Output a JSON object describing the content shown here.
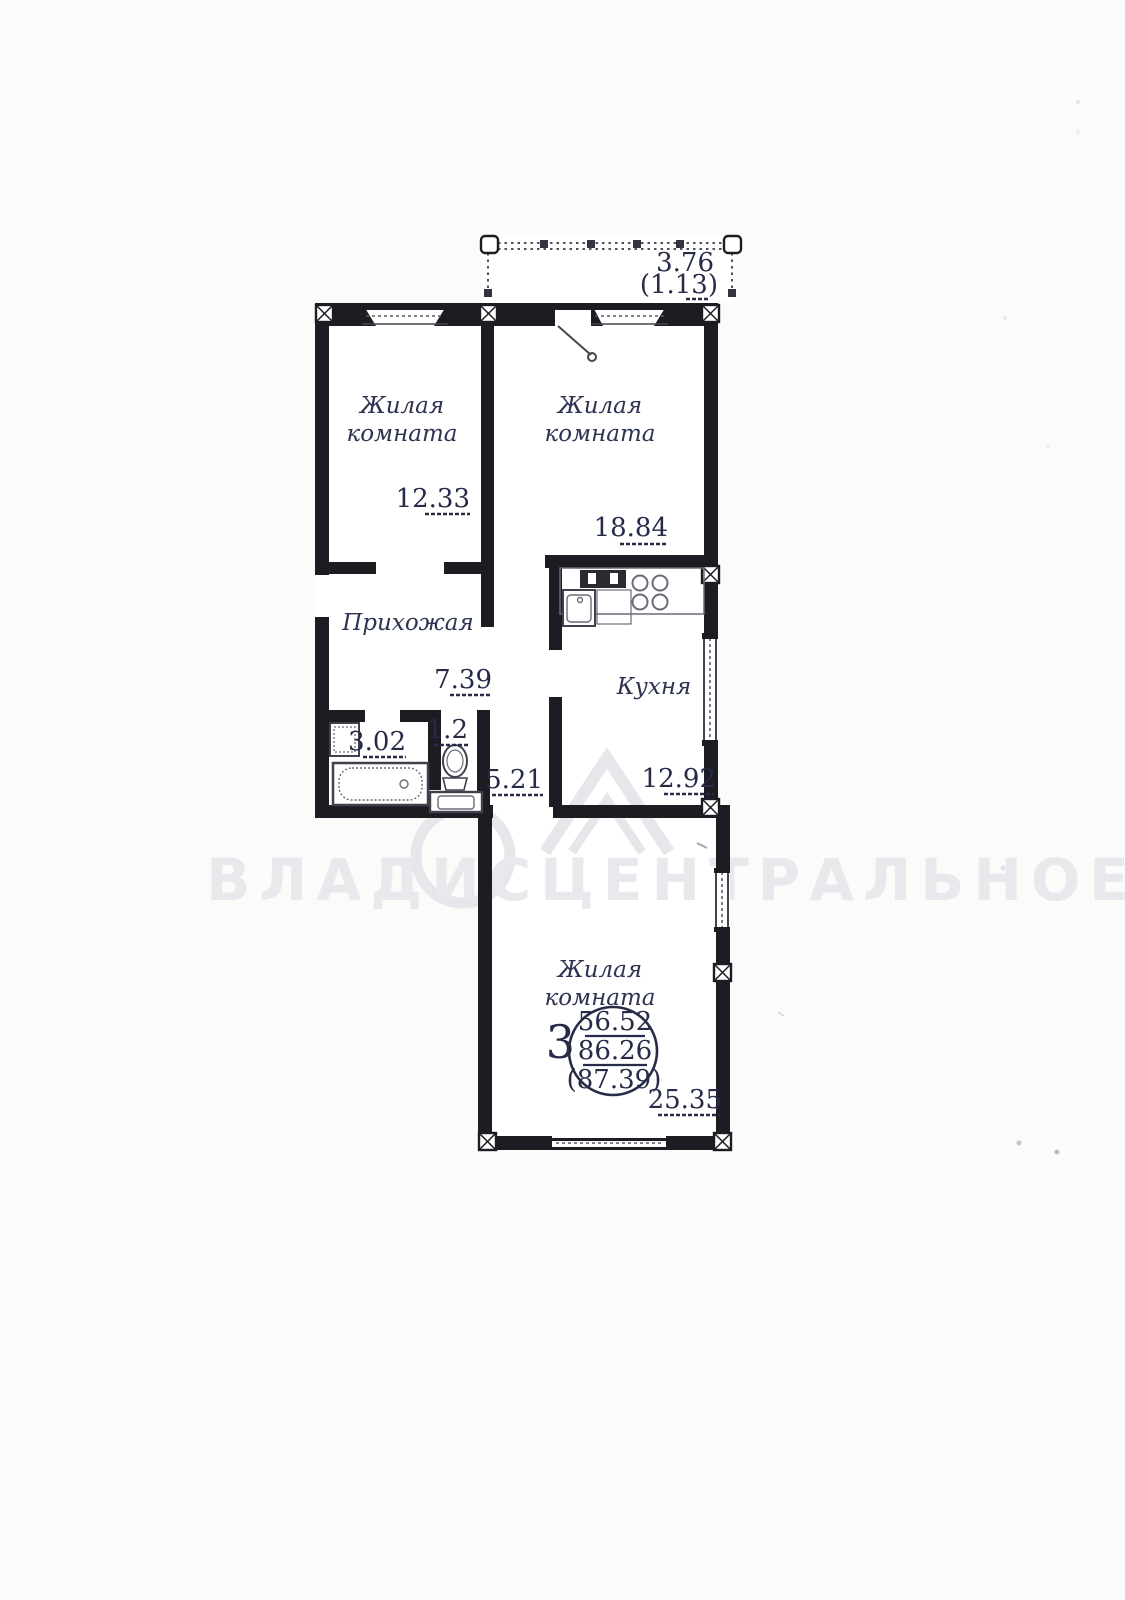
{
  "document_type": "apartment floor plan scan",
  "balcony": {
    "width_dim": "3.76",
    "area_dim": "(1.13)"
  },
  "rooms": {
    "living1": {
      "name1": "Жилая",
      "name2": "комната",
      "area": "12.33"
    },
    "living2": {
      "name1": "Жилая",
      "name2": "комната",
      "area": "18.84"
    },
    "hall": {
      "name": "Прихожая",
      "area": "7.39"
    },
    "bath": {
      "area": "3.02"
    },
    "wc": {
      "area": "1.2"
    },
    "corridor": {
      "area": "5.21"
    },
    "kitchen": {
      "name": "Кухня",
      "area": "12.92"
    },
    "living3": {
      "name1": "Жилая",
      "name2": "комната",
      "area": "25.35"
    }
  },
  "summary": {
    "room_count": "3",
    "living_area": "56.52",
    "floor_area": "86.26",
    "total_area_with_balcony": "(87.39)"
  },
  "watermark": {
    "text": "ВЛАДИСЦЕНТРАЛЬНОЕ"
  },
  "colors": {
    "paper": "#fbfbfa",
    "wall": "#1c1c22",
    "ink": "#262c47",
    "watermark": "#e9e9ed"
  }
}
